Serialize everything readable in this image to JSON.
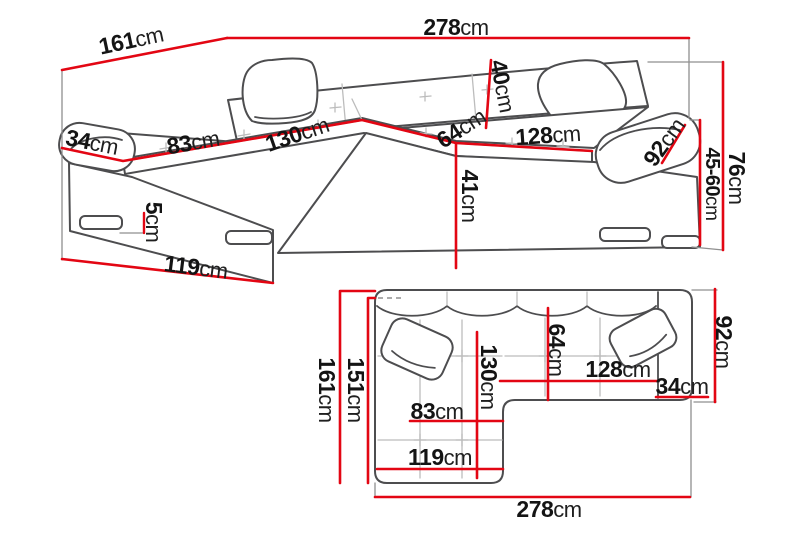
{
  "diagram": {
    "subject": "corner-sofa-dimension-diagram",
    "colors": {
      "dimension_line": "#e30613",
      "outline": "#4d4d4f",
      "detail": "#bcbcbc",
      "text": "#141414",
      "background": "#ffffff"
    },
    "views": {
      "perspective": {
        "dims": {
          "total_width": {
            "value": "278",
            "unit": "cm"
          },
          "total_depth": {
            "value": "161",
            "unit": "cm"
          },
          "arm_width_left": {
            "value": "34",
            "unit": "cm"
          },
          "chaise_seat": {
            "value": "83",
            "unit": "cm"
          },
          "chaise_length": {
            "value": "130",
            "unit": "cm"
          },
          "corner_seat": {
            "value": "64",
            "unit": "cm"
          },
          "seat_length": {
            "value": "128",
            "unit": "cm"
          },
          "back_height": {
            "value": "40",
            "unit": "cm"
          },
          "seat_height": {
            "value": "41",
            "unit": "cm"
          },
          "arm_depth_right": {
            "value": "92",
            "unit": "cm"
          },
          "leg_height": {
            "value": "5",
            "unit": "cm"
          },
          "chaise_width": {
            "value": "119",
            "unit": "cm"
          },
          "total_height": {
            "value": "76",
            "unit": "cm"
          },
          "arm_height": {
            "value": "45-60",
            "unit": "cm"
          }
        }
      },
      "plan": {
        "dims": {
          "depth_total": {
            "value": "161",
            "unit": "cm"
          },
          "depth_inner": {
            "value": "151",
            "unit": "cm"
          },
          "chaise_length": {
            "value": "130",
            "unit": "cm"
          },
          "seat_depth": {
            "value": "64",
            "unit": "cm"
          },
          "arm_depth": {
            "value": "92",
            "unit": "cm"
          },
          "chaise_seat": {
            "value": "83",
            "unit": "cm"
          },
          "chaise_width": {
            "value": "119",
            "unit": "cm"
          },
          "seat_length": {
            "value": "128",
            "unit": "cm"
          },
          "arm_width": {
            "value": "34",
            "unit": "cm"
          },
          "width_total": {
            "value": "278",
            "unit": "cm"
          }
        }
      }
    }
  }
}
